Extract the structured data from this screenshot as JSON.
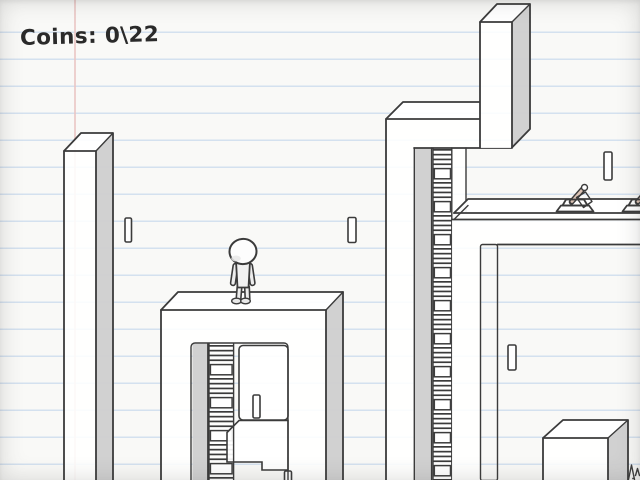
{
  "hud": {
    "coins_label": "Coins: 0\\22",
    "coins_current": 0,
    "coins_total": 22
  },
  "palette": {
    "paper": "#f9f9f7",
    "rule_line": "#d4e1ef",
    "margin_line": "#eac5c3",
    "ink": "#3b3b3b",
    "face": "#ffffff",
    "shade": "#cfcfcf",
    "dark_shade": "#b9b9b9",
    "hud_text": "#2a2a2a",
    "barrel": "#dcc3b4"
  },
  "entities": {
    "player": {
      "name": "stick-figure-player",
      "state": "standing-on-tower"
    },
    "coins_visible": 6,
    "turrets_visible": 2,
    "ladders_visible": 2,
    "crates_visible": 1,
    "pillars_visible": 4
  },
  "style": {
    "theme": "hand-drawn notebook platformer"
  }
}
